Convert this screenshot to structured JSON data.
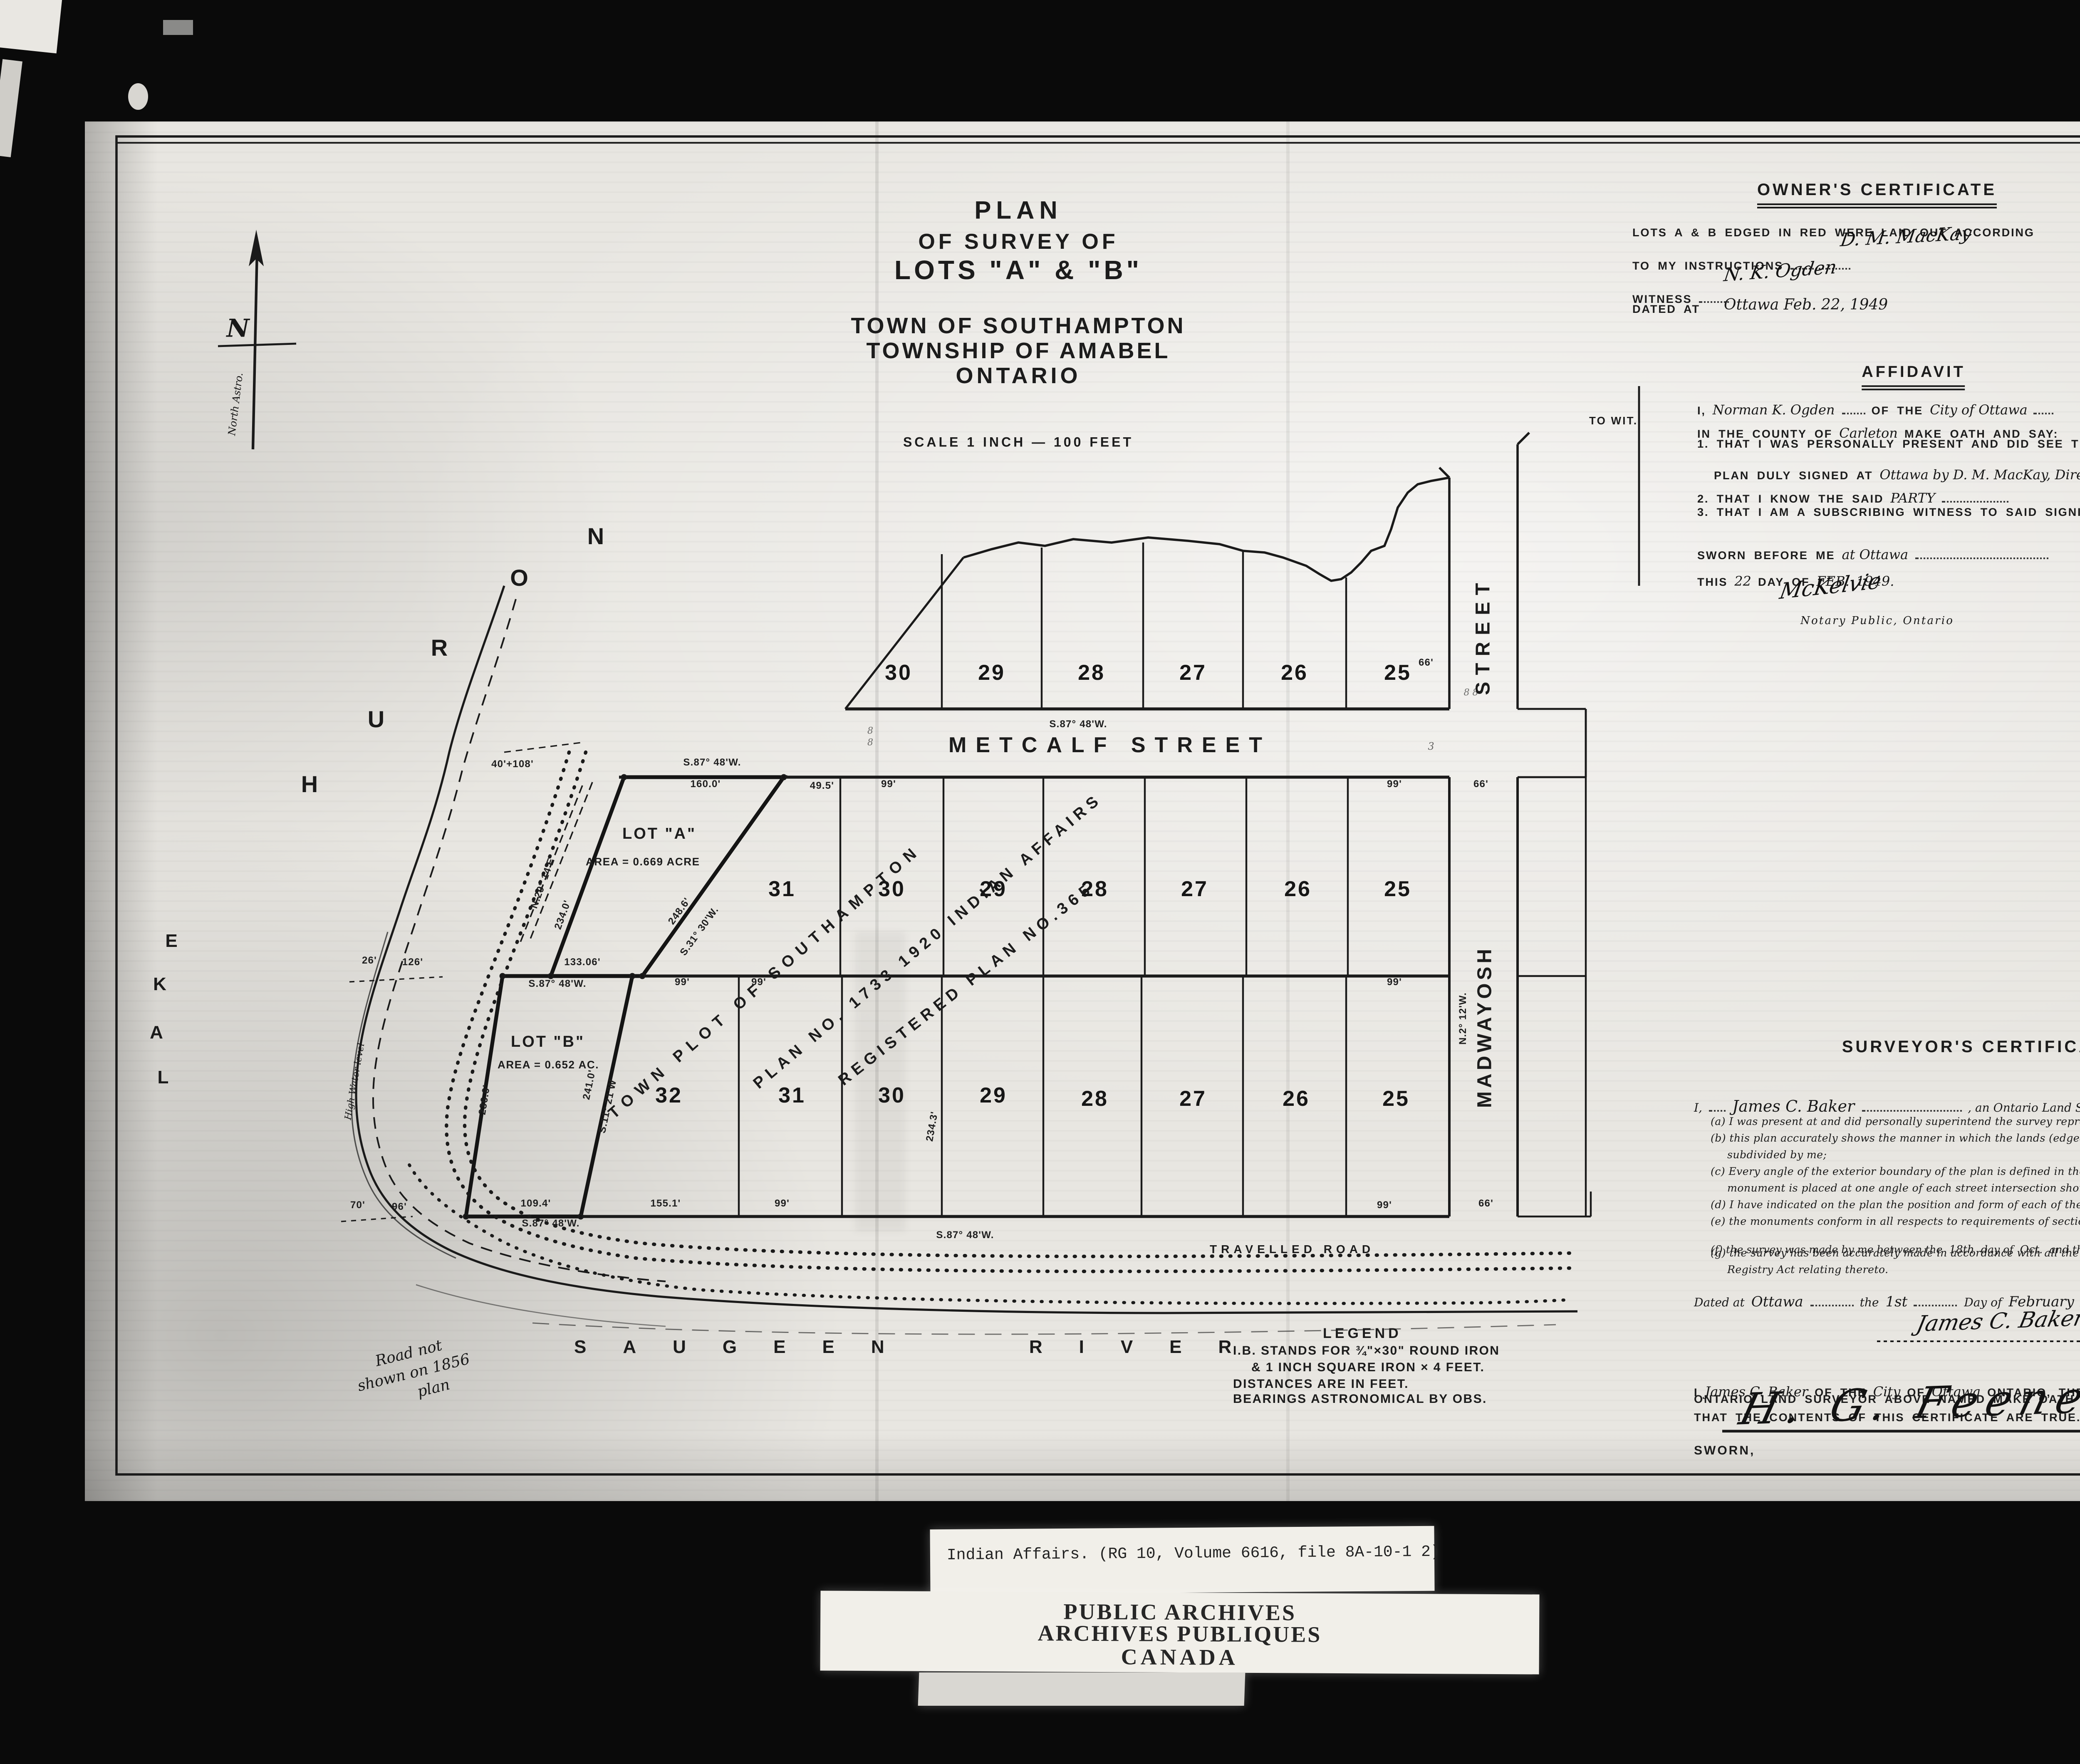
{
  "title_block": {
    "l1": "PLAN",
    "l2": "OF SURVEY OF",
    "l3": "LOTS \"A\" & \"B\"",
    "l4": "TOWN OF SOUTHAMPTON",
    "l5": "TOWNSHIP OF AMABEL",
    "l6": "ONTARIO",
    "scale": "SCALE 1 INCH — 100 FEET"
  },
  "owners_certificate": {
    "heading": "OWNER'S CERTIFICATE",
    "body1": "LOTS A & B EDGED IN RED WERE LAID OUT ACCORDING",
    "body2": "TO MY INSTRUCTIONS",
    "sig_owner": "D. M. MacKay",
    "role1": "Director, Indian",
    "role2": "— Affairs Branch",
    "witness_label": "WITNESS",
    "sig_witness": "N. K. Ogden",
    "dated_label": "DATED AT",
    "dated_value": "Ottawa   Feb. 22, 1949"
  },
  "affidavit": {
    "heading": "AFFIDAVIT",
    "to_wit": "TO WIT.",
    "i": "I,",
    "deponent": "Norman K. Ogden",
    "of_the": "OF THE",
    "city": "City of Ottawa",
    "county_pre": "IN THE COUNTY OF",
    "county": "Carleton",
    "county_post": "MAKE OATH AND SAY:",
    "item1a": "1. THAT I WAS PERSONALLY PRESENT AND DID SEE THIS",
    "item1b": "PLAN DULY SIGNED AT",
    "item1b_hw": "Ottawa by D. M. MacKay, Director",
    "item2": "2. THAT I KNOW THE SAID",
    "item2_hw": "PARTY",
    "item3": "3. THAT I AM A SUBSCRIBING WITNESS TO SAID SIGNING",
    "sworn_pre": "SWORN BEFORE ME",
    "sworn_hw": "at Ottawa",
    "sig_witness": "N. K. Ogden",
    "this_pre": "THIS",
    "this_day": "22",
    "day_of": "DAY OF",
    "month": "FEB.",
    "year": "1949.",
    "sig_notary": "McKelvie",
    "notary_title": "Notary Public, Ontario"
  },
  "surveyors_certificate": {
    "heading": "SURVEYOR'S CERTIFICATE",
    "i": "I,",
    "surveyor": "James C. Baker",
    "intro": ", an Ontario Land Surveyor, certify that,-",
    "a": "(a) I was present at and did personally superintend the survey represented by this plan;",
    "b": "(b) this plan accurately shows the manner in which the lands (edged in red) have been surveyed and subdivided by me;",
    "c": "(c) Every angle of the exterior boundary of the plan is defined in the survey thereof by a monument and a monument is placed at one angle of each street intersection shown on the plan;",
    "d": "(d) I have indicated on the plan the position and form of each of the monuments;",
    "e": "(e) the monuments conform in all respects to requirements of section 13 of The Surveys Act;",
    "f_pre": "(f) the survey was made by me between the",
    "f_d1": "18th",
    "f_m1": "day of",
    "f_oct": "Oct.",
    "f_and": "and the",
    "f_d2": "18th",
    "f_m2": "day of",
    "f_nov": "Nov/48.",
    "g": "(g) the survey has been accurately made in accordance with all the provisions of The Surveys Act and The Registry Act relating thereto.",
    "dated_pre": "Dated at",
    "dated_place": "Ottawa",
    "the": "the",
    "dated_day": "1st",
    "day_of": "Day of",
    "dated_month": "February",
    "dated_year": "A.D.1949 :",
    "sig_surveyor": "James C. Baker",
    "sig_role": "Ontario Land Surveyor.",
    "oath1_i": "I",
    "oath1_hw1": "James C. Baker",
    "oath1_b": "OF THE",
    "oath1_hw2": "City",
    "oath1_c": "OF",
    "oath1_hw3": "Ottawa",
    "oath1_d": "ONTARIO, THE",
    "oath2": "ONTARIO LAND SURVEYOR ABOVE NAMED MAKE OATH AND SAY",
    "oath3": "THAT THE CONTENTS OF THIS CERTIFICATE ARE TRUE.",
    "sworn": "SWORN,",
    "sig_commissioner": "H. G. Feeney  Comm.",
    "exd": "Ex'd. J.C.B.  7/2/49."
  },
  "legend": {
    "heading": "LEGEND",
    "l1": "I.B. STANDS FOR ¾\"×30\" ROUND IRON",
    "l2": "& 1 INCH SQUARE IRON × 4 FEET.",
    "l3": "DISTANCES ARE IN FEET.",
    "l4": "BEARINGS ASTRONOMICAL BY OBS."
  },
  "map": {
    "north_label": "North Astro.",
    "n_glyph": "N",
    "lake": [
      "L",
      "A",
      "K",
      "E"
    ],
    "huron": [
      "H",
      "U",
      "R",
      "O",
      "N"
    ],
    "saugeen": "SAUGEEN RIVER",
    "metcalf": "METCALF STREET",
    "madwayosh": "MADWAYOSH",
    "street_word": "STREET",
    "travelled_road": "TRAVELLED ROAD",
    "lot_a_label": "LOT \"A\"",
    "lot_a_area": "AREA = 0.669 ACRE",
    "lot_b_label": "LOT \"B\"",
    "lot_b_area": "AREA = 0.652 AC.",
    "diag1": "TOWN PLOT OF SOUTHAMPTON",
    "diag2": "PLAN NO. 1733 1920 INDIAN AFFAIRS",
    "diag3": "REGISTERED PLAN NO.365",
    "note_1856_l1": "Road not",
    "note_1856_l2": "shown on 1856",
    "note_1856_l3": "plan",
    "high_water": "High Water level",
    "lots_top": [
      "30",
      "29",
      "28",
      "27",
      "26",
      "25"
    ],
    "lots_mid": [
      "31",
      "30",
      "29",
      "28",
      "27",
      "26",
      "25"
    ],
    "lots_bot": [
      "32",
      "31",
      "30",
      "29",
      "28",
      "27",
      "26",
      "25"
    ],
    "meas": {
      "metcalf_bearing": "S.87° 48'W.",
      "lota_bearing": "S.87° 48'W.",
      "d160": "160.0'",
      "d49": "49.5'",
      "d99a": "99'",
      "d99b": "99'",
      "d66a": "66'",
      "d66c": "66'",
      "d40_108": "40'+108'",
      "n29": "N.29° 14'E",
      "d234": "234.0'",
      "d248": "248.6'",
      "s31": "S.31° 30'W.",
      "d133": "133.06'",
      "b133": "S.87° 48'W.",
      "d99c": "99'",
      "d99d": "99'",
      "d99e": "99'",
      "d236": "236.6'",
      "d241": "241.0'",
      "s11": "S.11° 21'W",
      "d109": "109.4'",
      "d155": "155.1'",
      "d99f": "99'",
      "d99g": "99'",
      "d66b": "66'",
      "bot_bearing": "S.87° 48'W.",
      "road_bearing": "S.87° 48'W.",
      "d26": "26'",
      "d126": "126'",
      "d70": "70'",
      "d96": "96'",
      "d2343": "234.3'",
      "madw_bearing": "N.2° 12'W.",
      "mark3": "3",
      "mark8a": "8",
      "mark8b": "8",
      "mark8c": "8 8"
    }
  },
  "stamps": {
    "file_line": "Indian Affairs. (RG 10, Volume 6616, file 8A-10-1  2)",
    "pa1": "PUBLIC ARCHIVES",
    "pa2": "ARCHIVES PUBLIQUES",
    "pa3": "CANADA"
  }
}
